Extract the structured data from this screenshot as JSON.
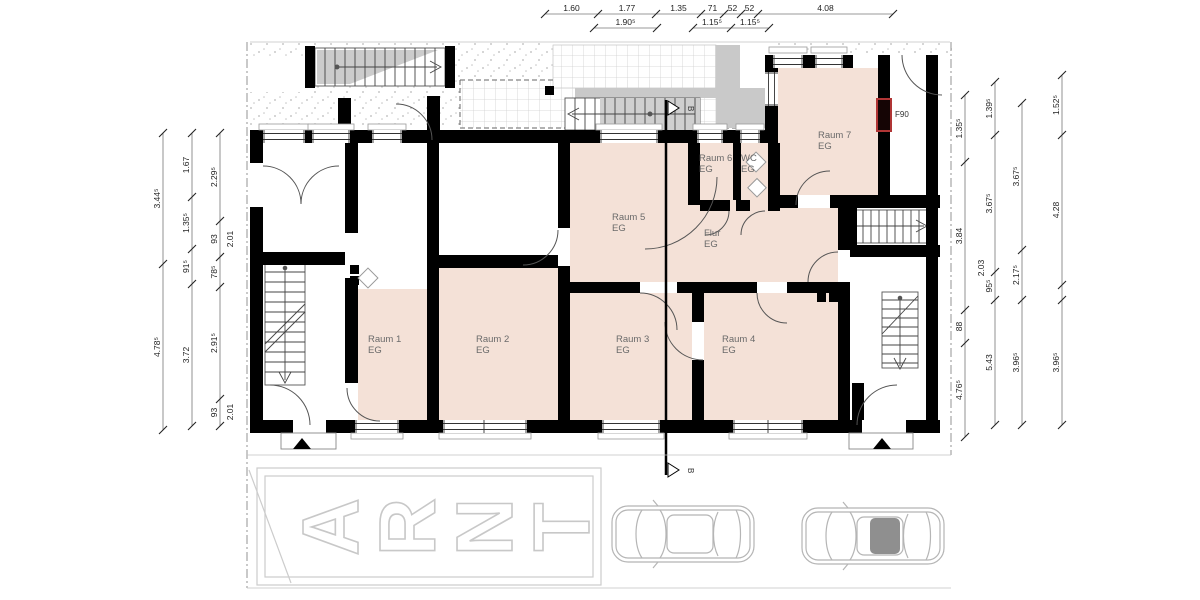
{
  "plan": {
    "rooms": [
      {
        "label": "Raum 1",
        "sub": "EG",
        "x": 368,
        "y": 342
      },
      {
        "label": "Raum 2",
        "sub": "EG",
        "x": 476,
        "y": 342
      },
      {
        "label": "Raum 3",
        "sub": "EG",
        "x": 616,
        "y": 342
      },
      {
        "label": "Raum 4",
        "sub": "EG",
        "x": 722,
        "y": 342
      },
      {
        "label": "Raum 5",
        "sub": "EG",
        "x": 612,
        "y": 220
      },
      {
        "label": "Raum 6",
        "sub": "EG",
        "x": 699,
        "y": 161
      },
      {
        "label": "WC",
        "sub": "EG",
        "x": 741,
        "y": 161
      },
      {
        "label": "Raum 7",
        "sub": "EG",
        "x": 818,
        "y": 138
      },
      {
        "label": "Flur",
        "sub": "EG",
        "x": 704,
        "y": 236
      }
    ],
    "markers": {
      "f90_label": "F90",
      "section_label": "B"
    }
  },
  "dims": {
    "chains": [
      {
        "o": "h",
        "p": 14,
        "t": [
          545,
          598,
          656,
          701,
          724,
          741,
          758,
          893
        ],
        "l": [
          {
            "s": "1.60",
            "a": 545,
            "b": 598
          },
          {
            "s": "1.77",
            "a": 598,
            "b": 656
          },
          {
            "s": "1.35",
            "a": 656,
            "b": 701
          },
          {
            "s": "71",
            "a": 701,
            "b": 724
          },
          {
            "s": "52",
            "a": 724,
            "b": 741
          },
          {
            "s": "52",
            "a": 741,
            "b": 758
          },
          {
            "s": "4.08",
            "a": 758,
            "b": 893
          }
        ]
      },
      {
        "o": "h",
        "p": 28,
        "t": [
          594,
          657
        ],
        "l": [
          {
            "s": "1.90⁵",
            "a": 594,
            "b": 657
          }
        ]
      },
      {
        "o": "h",
        "p": 28,
        "t": [
          693,
          731,
          769
        ],
        "l": [
          {
            "s": "1.15⁵",
            "a": 693,
            "b": 731
          },
          {
            "s": "1.15⁵",
            "a": 731,
            "b": 769
          }
        ]
      },
      {
        "o": "v",
        "p": 163,
        "t": [
          133,
          264,
          430
        ],
        "l": [
          {
            "s": "3.44⁵",
            "a": 133,
            "b": 264
          },
          {
            "s": "4.78⁵",
            "a": 264,
            "b": 430
          }
        ]
      },
      {
        "o": "v",
        "p": 192,
        "t": [
          133,
          197,
          249,
          284,
          426
        ],
        "l": [
          {
            "s": "1.67",
            "a": 133,
            "b": 197
          },
          {
            "s": "1.35⁵",
            "a": 197,
            "b": 249
          },
          {
            "s": "91⁵",
            "a": 249,
            "b": 284
          },
          {
            "s": "3.72",
            "a": 284,
            "b": 426
          }
        ]
      },
      {
        "o": "v",
        "p": 220,
        "t": [
          133,
          221,
          257,
          287,
          399,
          426
        ],
        "l": [
          {
            "s": "2.29⁵",
            "a": 133,
            "b": 221
          },
          {
            "s": "93",
            "a": 221,
            "b": 257
          },
          {
            "s": "78⁵",
            "a": 257,
            "b": 287
          },
          {
            "s": "2.91⁵",
            "a": 287,
            "b": 399
          },
          {
            "s": "93",
            "a": 399,
            "b": 426
          }
        ]
      },
      {
        "o": "v",
        "p": 965,
        "t": [
          95,
          162,
          310,
          343,
          437
        ],
        "l": [
          {
            "s": "1.35⁵",
            "a": 95,
            "b": 162
          },
          {
            "s": "3.84",
            "a": 162,
            "b": 310
          },
          {
            "s": "88",
            "a": 310,
            "b": 343
          },
          {
            "s": "4.76⁵",
            "a": 343,
            "b": 437
          }
        ]
      },
      {
        "o": "v",
        "p": 995,
        "t": [
          82,
          135,
          272,
          300,
          425
        ],
        "l": [
          {
            "s": "1.39⁵",
            "a": 82,
            "b": 135
          },
          {
            "s": "3.67⁵",
            "a": 135,
            "b": 272
          },
          {
            "s": "95⁵",
            "a": 272,
            "b": 300
          },
          {
            "s": "5.43",
            "a": 300,
            "b": 425
          }
        ]
      },
      {
        "o": "v",
        "p": 1022,
        "t": [
          103,
          250,
          300,
          425
        ],
        "l": [
          {
            "s": "3.67⁵",
            "a": 103,
            "b": 250
          },
          {
            "s": "2.17⁵",
            "a": 250,
            "b": 300
          },
          {
            "s": "3.96⁵",
            "a": 300,
            "b": 425
          }
        ]
      },
      {
        "o": "v",
        "p": 1062,
        "t": [
          75,
          135,
          285,
          300,
          425
        ],
        "l": [
          {
            "s": "1.52⁵",
            "a": 75,
            "b": 135
          },
          {
            "s": "4.28",
            "a": 135,
            "b": 285
          },
          {
            "s": "3.96⁵",
            "a": 300,
            "b": 425
          }
        ]
      }
    ],
    "offsets": [
      {
        "s": "2.01",
        "x": 233,
        "y": 239
      },
      {
        "s": "2.01",
        "x": 233,
        "y": 412
      },
      {
        "s": "2.03",
        "x": 984,
        "y": 268
      }
    ]
  },
  "parking": {
    "letters": [
      "A",
      "R",
      "N",
      "T"
    ]
  },
  "colors": {
    "room_fill": "#f4e1d7",
    "wall": "#000000",
    "fire_door": "#b03535",
    "concrete": "#c9c9c9"
  }
}
